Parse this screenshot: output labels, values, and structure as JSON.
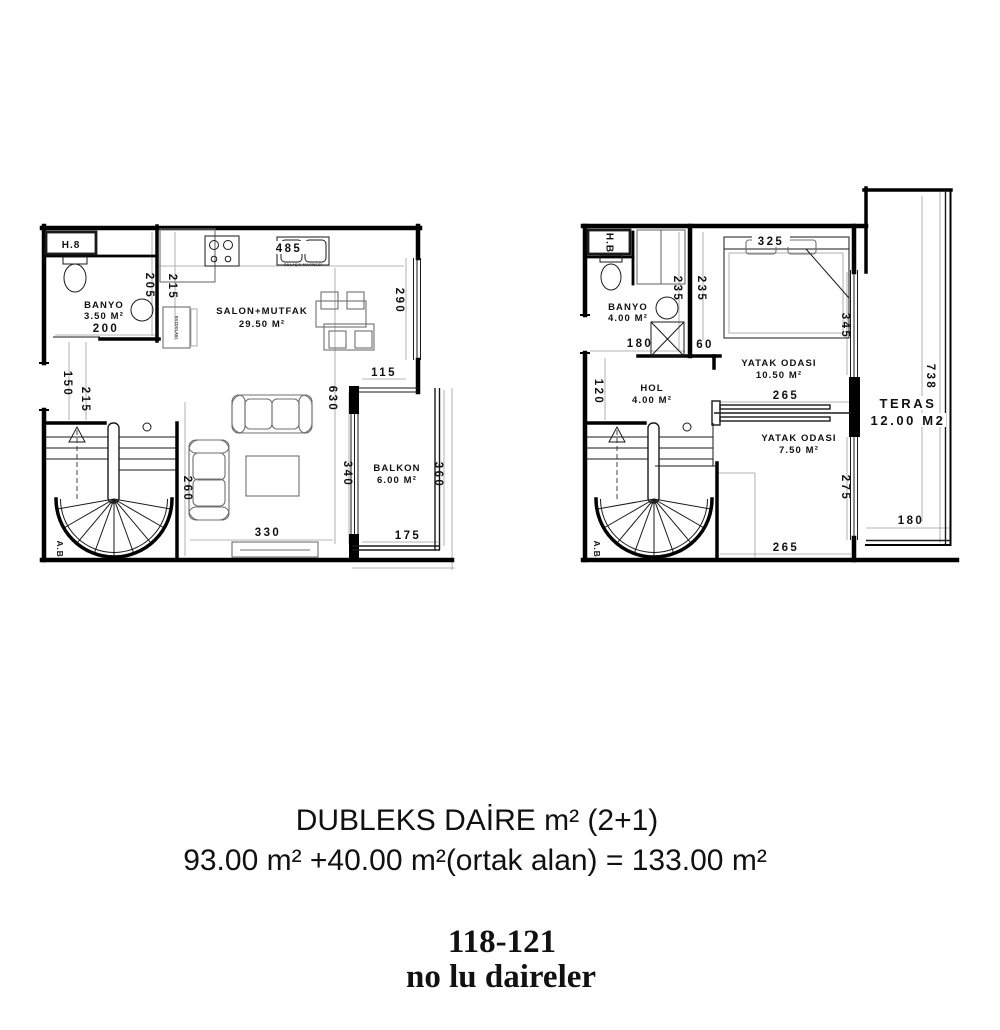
{
  "plans": {
    "left": {
      "unit_label": "H.8",
      "stair_label": "A.B",
      "rooms": {
        "banyo": {
          "name": "BANYO",
          "area": "3.50 M²"
        },
        "salon": {
          "name": "SALON+MUTFAK",
          "area": "29.50 M²"
        },
        "balkon": {
          "name": "BALKON",
          "area": "6.00 M²"
        }
      },
      "appliances": {
        "dishwasher": "BULAŞIK MAKİNESİ",
        "fridge": "BUZDOLABI"
      },
      "dims": {
        "sink": "485",
        "wall_a": "205",
        "wall_b": "215",
        "banyo_w": "200",
        "entry_a": "150",
        "entry_b": "215",
        "window": "290",
        "balkon_door": "115",
        "salon_h": "630",
        "balkon_h": "340",
        "balkon_out": "360",
        "balkon_w": "175",
        "salon_w": "330",
        "sofa_wall": "260"
      }
    },
    "right": {
      "unit_label": "H.B",
      "stair_label": "A.B",
      "rooms": {
        "banyo": {
          "name": "BANYO",
          "area": "4.00 M²"
        },
        "hol": {
          "name": "HOL",
          "area": "4.00 M²"
        },
        "yatak1": {
          "name": "YATAK ODASI",
          "area": "10.50 M²"
        },
        "yatak2": {
          "name": "YATAK ODASI",
          "area": "7.50 M²"
        },
        "teras": {
          "name": "TERAS",
          "area": "12.00 M2"
        }
      },
      "dims": {
        "bed": "325",
        "wall_a": "235",
        "wall_b": "235",
        "banyo_w": "180",
        "niche": "60",
        "window_a": "345",
        "yatak1_w": "265",
        "hol_h": "120",
        "window_b": "275",
        "yatak2_w": "265",
        "teras_h": "738",
        "teras_w": "180"
      }
    }
  },
  "caption": {
    "line1": "DUBLEKS DAİRE m² (2+1)",
    "line2": "93.00 m² +40.00 m²(ortak alan) = 133.00 m²",
    "units_range": "118-121",
    "units_label": "no lu daireler"
  }
}
